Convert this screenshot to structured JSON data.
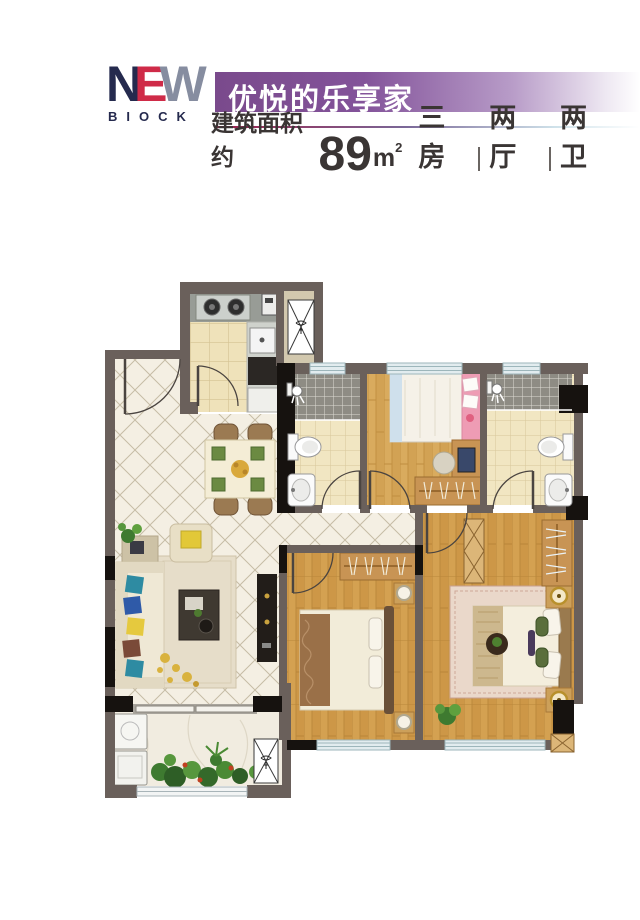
{
  "header": {
    "logo_primary": "NEW",
    "logo_letters": {
      "l1": "N",
      "l2": "E",
      "l3": "W"
    },
    "logo_secondary": "BIOCK",
    "banner_title": "优悦的乐享家",
    "area_prefix": "建筑面积约",
    "area_value": "89",
    "area_unit": "m",
    "area_unit_sup": "2",
    "specs": [
      "三房",
      "两厅",
      "两卫"
    ]
  },
  "colors": {
    "banner_purple": "#7a4a8c",
    "logo_navy": "#252a4e",
    "logo_red": "#cf2b48",
    "logo_silver": "#868da0",
    "rule_crimson": "#9c1f4a",
    "text_dark": "#3a3534",
    "wall_gray": "#6a605b",
    "wall_black": "#16120f",
    "window_blue": "#e2ecef",
    "wood_floor": "#d4a151",
    "tile_beige": "#efe2ba",
    "marble_cream": "#f4efe3",
    "mosaic_gray": "#8e8c84",
    "wardrobe_wood": "#c89454",
    "sofa_beige": "#efe8d5",
    "rug_master": "#ead8ca"
  },
  "icons": {
    "gas_stove": "two-burner-stove",
    "kitchen_sink": "sink",
    "duct": "shaft-x-symbol",
    "shower": "shower-head",
    "toilet": "toilet",
    "basin": "wash-basin",
    "washer": "washing-machine",
    "plant": "green-plant",
    "door": "quarter-arc-door",
    "window": "triple-line-window"
  }
}
